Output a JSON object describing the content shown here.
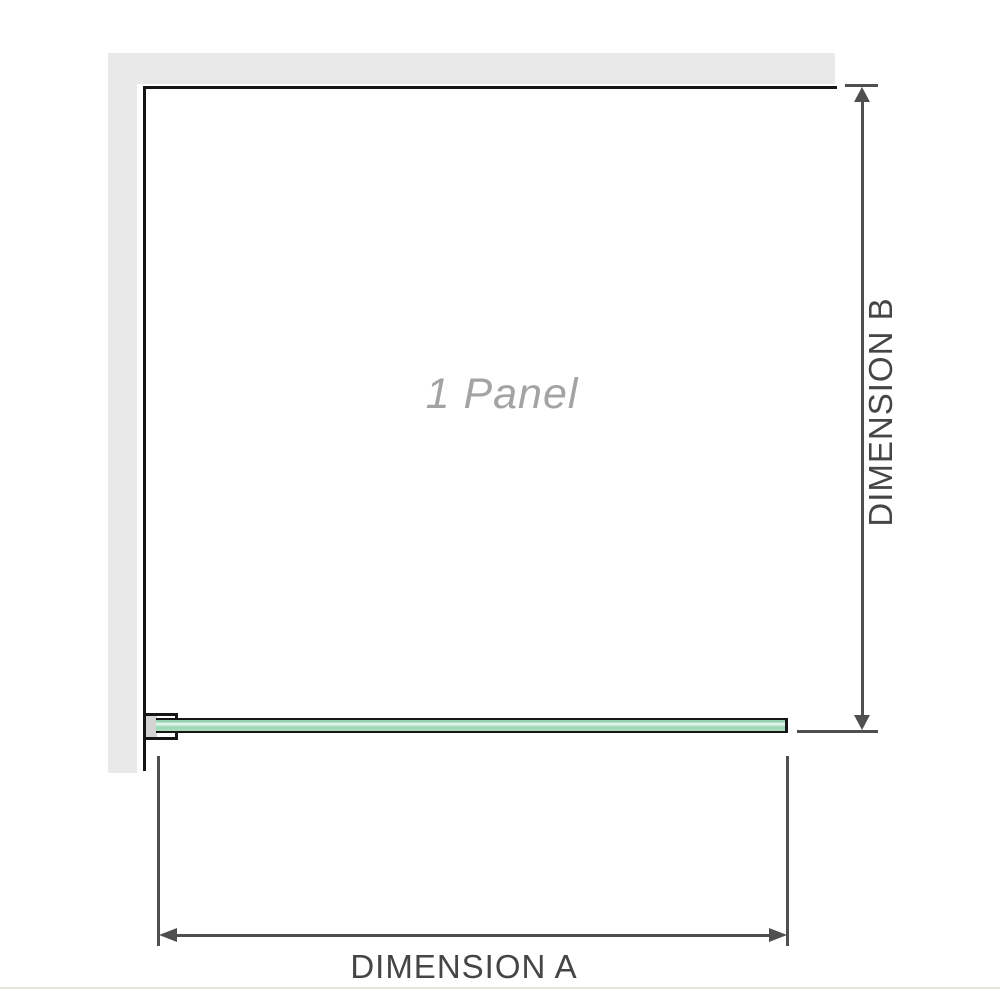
{
  "diagram": {
    "panel_label": "1 Panel",
    "dimension_a": {
      "label": "DIMENSION A",
      "orientation": "horizontal"
    },
    "dimension_b": {
      "label": "DIMENSION B",
      "orientation": "vertical"
    }
  },
  "colors": {
    "wall": "#e9e9e9",
    "outline": "#161616",
    "dim": "#4f4f4f",
    "label": "#454545",
    "panel-text": "#a3a3a3",
    "bracket-block": "#d3d3d3",
    "baseline": "#e9e6dd",
    "glass-a": "#93d2af",
    "glass-b": "#e2f5ea",
    "glass-c": "#9cd7b7",
    "glass-d": "#a9ddc0"
  }
}
